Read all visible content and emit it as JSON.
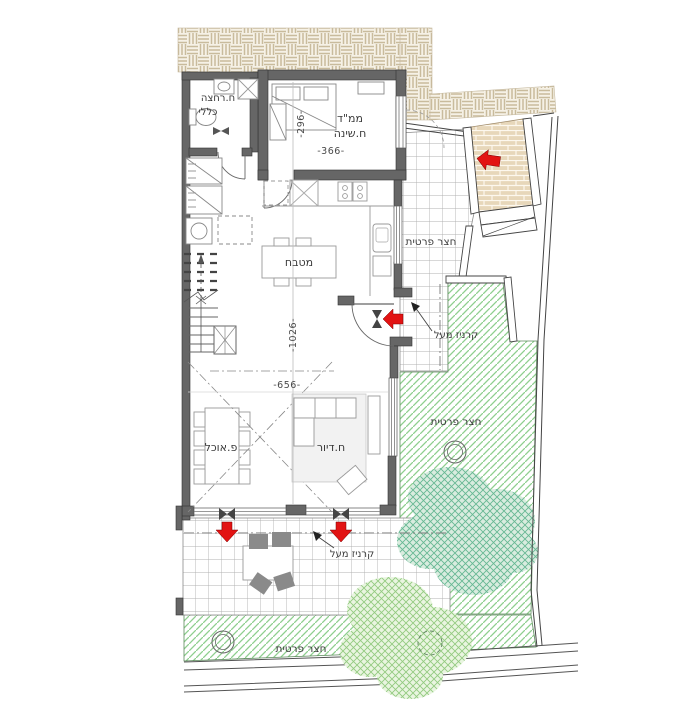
{
  "labels": {
    "bathroom_1": "ח.רחצה",
    "bathroom_2": "כללי",
    "saferoom_1": "ממ\"ד",
    "saferoom_2": "ח.שינה",
    "kitchen": "מטבח",
    "dining": "פ.אוכל",
    "living": "ח.דיור",
    "yard_east_upper": "חצר פרטית",
    "yard_east_lower": "חצר פרטית",
    "yard_south": "חצר פרטית",
    "cornice_east": "קרניז מעל",
    "cornice_south": "קרניז מעל"
  },
  "dimensions": {
    "saferoom_depth": "-296-",
    "saferoom_width": "-366-",
    "living_width": "-656-",
    "plan_length": "-1026-"
  },
  "colors": {
    "wall": "#666666",
    "entry_arrow": "#e21313",
    "green_hatch": "#8ecf8e",
    "brick_paving": "#e7d7ba",
    "basket_paving": "#f6f1e6"
  }
}
